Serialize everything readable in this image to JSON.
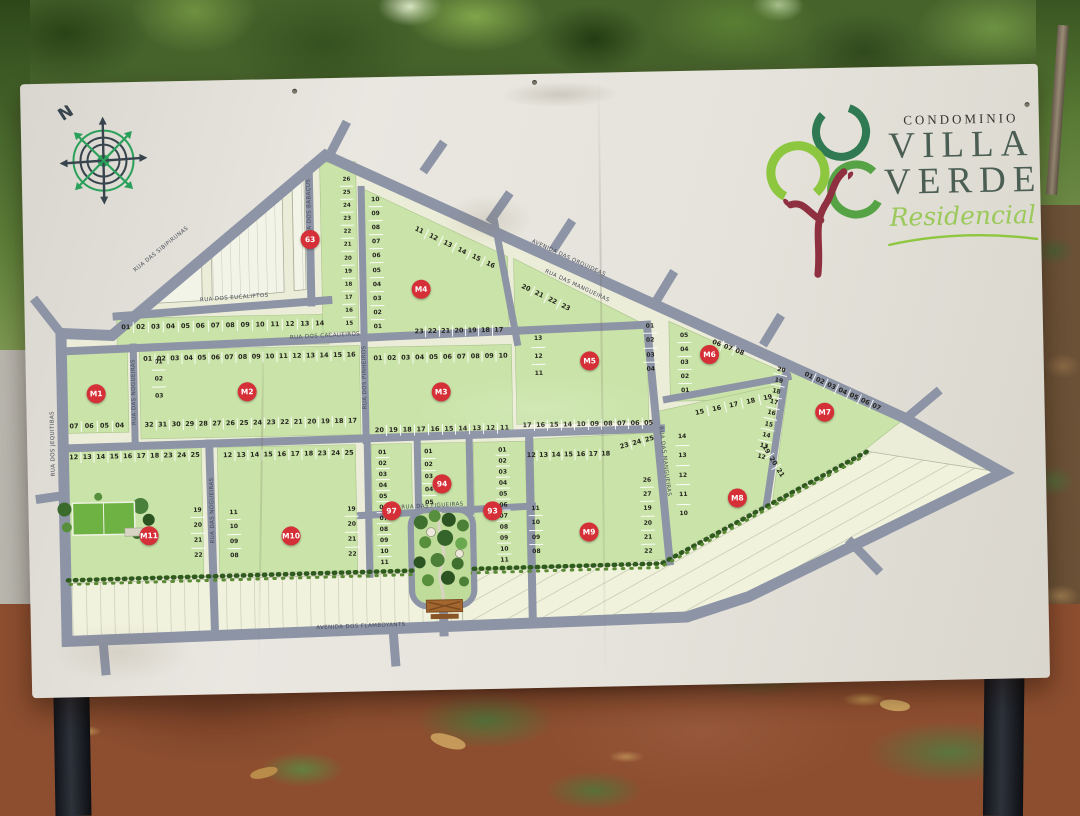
{
  "sign": {
    "logo": {
      "prefix": "CONDOMINIO",
      "title_line1": "VILLA",
      "title_line2": "VERDE",
      "subtitle": "Residencial"
    },
    "compass": {
      "north": "N"
    }
  },
  "map": {
    "streets": [
      {
        "name": "RUA DAS SIBIPIRUNAS"
      },
      {
        "name": "RUA DOS EUCALIPTOS"
      },
      {
        "name": "RUA DOS CACAUEIROS"
      },
      {
        "name": "RUA DOS BABAÇUS"
      },
      {
        "name": "AVENIDA DAS ORQUIDEAS"
      },
      {
        "name": "RUA DAS MANGUEIRAS"
      },
      {
        "name": "RUA DOS PINHEIROS"
      },
      {
        "name": "RUA DAS NOGUEIRAS"
      },
      {
        "name": "RUA DAS FIGUEIRAS"
      },
      {
        "name": "RUA DOS JEQUITIBAS"
      },
      {
        "name": "AVENIDA DOS FLAMBOYANTS"
      }
    ],
    "markers": [
      {
        "label": "M1"
      },
      {
        "label": "M2"
      },
      {
        "label": "M3"
      },
      {
        "label": "M4"
      },
      {
        "label": "M5"
      },
      {
        "label": "M6"
      },
      {
        "label": "M7"
      },
      {
        "label": "M8"
      },
      {
        "label": "M9"
      },
      {
        "label": "M10"
      },
      {
        "label": "M11"
      },
      {
        "label": "63"
      },
      {
        "label": "97"
      },
      {
        "label": "94"
      },
      {
        "label": "93"
      }
    ],
    "blocks": {
      "strip": {
        "row": [
          "01",
          "02",
          "03",
          "04",
          "05",
          "06",
          "07",
          "08",
          "09",
          "10",
          "11",
          "12",
          "13",
          "14"
        ]
      },
      "m1": {
        "col": [
          "01",
          "02",
          "03"
        ],
        "bottom": [
          "07",
          "06",
          "05",
          "04"
        ]
      },
      "m2": {
        "top": [
          "01",
          "02",
          "03",
          "04",
          "05",
          "06",
          "07",
          "08",
          "09",
          "10",
          "11",
          "12",
          "13",
          "14",
          "15",
          "16"
        ],
        "bottom": [
          "32",
          "31",
          "30",
          "29",
          "28",
          "27",
          "26",
          "25",
          "24",
          "23",
          "22",
          "21",
          "20",
          "19",
          "18",
          "17"
        ]
      },
      "m3": {
        "top": [
          "01",
          "02",
          "03",
          "04",
          "05",
          "06",
          "07",
          "08",
          "09",
          "10"
        ],
        "bottom": [
          "20",
          "19",
          "18",
          "17",
          "16",
          "15",
          "14",
          "13",
          "12",
          "11"
        ]
      },
      "m4": {
        "col": [
          "10",
          "09",
          "08",
          "07",
          "06",
          "05",
          "04",
          "03",
          "02",
          "01"
        ],
        "diag": [
          "11",
          "12",
          "13",
          "14",
          "15",
          "16"
        ],
        "bottom": [
          "23",
          "22",
          "21",
          "20",
          "19",
          "18",
          "17"
        ]
      },
      "m5": {
        "diag": [
          "20",
          "21",
          "22",
          "23"
        ],
        "left": [
          "13",
          "12",
          "11"
        ],
        "right": [
          "01",
          "02",
          "03",
          "04"
        ],
        "bottom": [
          "17",
          "16",
          "15",
          "14",
          "10",
          "09",
          "08",
          "07",
          "06",
          "05"
        ]
      },
      "m6": {
        "col": [
          "05",
          "04",
          "03",
          "02",
          "01"
        ],
        "top": [
          "06",
          "07",
          "08"
        ]
      },
      "m7": {
        "diag": [
          "01",
          "02",
          "03",
          "04",
          "05",
          "06",
          "07"
        ],
        "col": [
          "20",
          "19",
          "18",
          "17",
          "16",
          "15",
          "14",
          "13",
          "12"
        ]
      },
      "m8": {
        "top_diag": [
          "15",
          "16",
          "17",
          "18",
          "19"
        ],
        "col": [
          "14",
          "13",
          "12",
          "11",
          "10"
        ],
        "diag": [
          "19",
          "20",
          "21"
        ]
      },
      "m9": {
        "top": [
          "12",
          "13",
          "14",
          "15",
          "16",
          "17",
          "18"
        ],
        "top2": [
          "23",
          "24",
          "25"
        ],
        "left": [
          "11",
          "10",
          "09",
          "08"
        ],
        "right": [
          "26",
          "27",
          "19",
          "20",
          "21",
          "22"
        ]
      },
      "m10": {
        "top": [
          "12",
          "13",
          "14",
          "15",
          "16",
          "17",
          "18",
          "23",
          "24",
          "25"
        ],
        "left": [
          "11",
          "10",
          "09",
          "08"
        ],
        "right": [
          "19",
          "20",
          "21",
          "22"
        ]
      },
      "m11": {
        "top": [
          "12",
          "13",
          "14",
          "15",
          "16",
          "17",
          "18",
          "23",
          "24",
          "25"
        ],
        "right": [
          "19",
          "20",
          "21",
          "22"
        ]
      },
      "b63": {
        "col": [
          "26",
          "25",
          "24",
          "23",
          "22",
          "21",
          "20",
          "19",
          "18",
          "17",
          "16",
          "15"
        ]
      },
      "b94": {
        "col": [
          "01",
          "02",
          "03",
          "04",
          "05"
        ]
      },
      "b97": {
        "col": [
          "01",
          "02",
          "03",
          "04",
          "05",
          "06",
          "07",
          "08",
          "09",
          "10",
          "11"
        ]
      },
      "b93": {
        "col": [
          "01",
          "02",
          "03",
          "04",
          "05",
          "06",
          "07",
          "08",
          "09",
          "10",
          "11"
        ]
      }
    }
  },
  "colors": {
    "marker_red": "#d52f38",
    "road_gray": "#8d94a6",
    "block_green": "#c9e3a8",
    "site_cream": "#ecedd9",
    "logo_light_green": "#8dc63f",
    "logo_dark_green": "#2f7a52",
    "logo_trunk": "#8e3040",
    "sign_white": "#e7e5de"
  }
}
